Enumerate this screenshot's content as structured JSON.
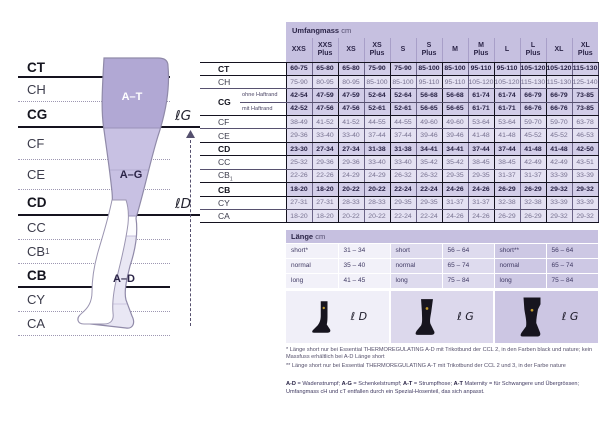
{
  "diagram": {
    "rows": [
      {
        "label": "CT",
        "bold": true
      },
      {
        "label": "CH"
      },
      {
        "label": "CG",
        "bold": true
      },
      {
        "label": "CF"
      },
      {
        "label": "CE"
      },
      {
        "label": "CD",
        "bold": true
      },
      {
        "label": "CC"
      },
      {
        "label": "CB",
        "label_sub": "1"
      },
      {
        "label": "CB",
        "bold": true
      },
      {
        "label": "CY"
      },
      {
        "label": "CA"
      }
    ],
    "region_labels": {
      "at": "A–T",
      "ag": "A–G",
      "ad": "A–D"
    },
    "markers": {
      "lg": "ℓG",
      "ld": "ℓD"
    }
  },
  "umfang": {
    "title": "Umfangmass",
    "unit": "cm",
    "sizes": [
      "XXS",
      "XXS Plus",
      "XS",
      "XS Plus",
      "S",
      "S Plus",
      "M",
      "M Plus",
      "L",
      "L Plus",
      "XL",
      "XL Plus"
    ],
    "rows": [
      {
        "label": "CT",
        "bold": true,
        "thick": true,
        "values": [
          "60-75",
          "65-80",
          "65-80",
          "75-90",
          "75-90",
          "85-100",
          "85-100",
          "95-110",
          "95-110",
          "105-120",
          "105-120",
          "115-130"
        ]
      },
      {
        "label": "CH",
        "values": [
          "75-90",
          "80-95",
          "80-95",
          "85-100",
          "85-100",
          "95-110",
          "95-110",
          "105-120",
          "105-120",
          "115-130",
          "115-130",
          "125-140"
        ]
      },
      {
        "label": "CG",
        "rowspan": 2,
        "sub_label": "ohne Haftrand",
        "bold": true,
        "values": [
          "42-54",
          "47-59",
          "47-59",
          "52-64",
          "52-64",
          "56-68",
          "56-68",
          "61-74",
          "61-74",
          "66-79",
          "66-79",
          "73-85"
        ]
      },
      {
        "sub_label": "mit Haftrand",
        "bold": true,
        "thick": true,
        "values": [
          "42-52",
          "47-56",
          "47-56",
          "52-61",
          "52-61",
          "56-65",
          "56-65",
          "61-71",
          "61-71",
          "66-76",
          "66-76",
          "73-85"
        ]
      },
      {
        "label": "CF",
        "values": [
          "38-49",
          "41-52",
          "41-52",
          "44-55",
          "44-55",
          "49-60",
          "49-60",
          "53-64",
          "53-64",
          "59-70",
          "59-70",
          "63-78"
        ]
      },
      {
        "label": "CE",
        "thick": true,
        "values": [
          "29-36",
          "33-40",
          "33-40",
          "37-44",
          "37-44",
          "39-46",
          "39-46",
          "41-48",
          "41-48",
          "45-52",
          "45-52",
          "46-53"
        ]
      },
      {
        "label": "CD",
        "bold": true,
        "thick": true,
        "values": [
          "23-30",
          "27-34",
          "27-34",
          "31-38",
          "31-38",
          "34-41",
          "34-41",
          "37-44",
          "37-44",
          "41-48",
          "41-48",
          "42-50"
        ]
      },
      {
        "label": "CC",
        "values": [
          "25-32",
          "29-36",
          "29-36",
          "33-40",
          "33-40",
          "35-42",
          "35-42",
          "38-45",
          "38-45",
          "42-49",
          "42-49",
          "43-51"
        ]
      },
      {
        "label": "CB",
        "label_sub": "1",
        "thick": true,
        "values": [
          "22-26",
          "22-26",
          "24-29",
          "24-29",
          "26-32",
          "26-32",
          "29-35",
          "29-35",
          "31-37",
          "31-37",
          "33-39",
          "33-39"
        ]
      },
      {
        "label": "CB",
        "bold": true,
        "thick": true,
        "values": [
          "18-20",
          "18-20",
          "20-22",
          "20-22",
          "22-24",
          "22-24",
          "24-26",
          "24-26",
          "26-29",
          "26-29",
          "29-32",
          "29-32"
        ]
      },
      {
        "label": "CY",
        "values": [
          "27-31",
          "27-31",
          "28-33",
          "28-33",
          "29-35",
          "29-35",
          "31-37",
          "31-37",
          "32-38",
          "32-38",
          "33-39",
          "33-39"
        ]
      },
      {
        "label": "CA",
        "thick": true,
        "values": [
          "18-20",
          "18-20",
          "20-22",
          "20-22",
          "22-24",
          "22-24",
          "24-26",
          "24-26",
          "26-29",
          "26-29",
          "29-32",
          "29-32"
        ]
      }
    ]
  },
  "laenge": {
    "title": "Länge",
    "unit": "cm",
    "groups": [
      {
        "rows": [
          [
            "short*",
            "31 – 34"
          ],
          [
            "normal",
            "35 – 40"
          ],
          [
            "long",
            "41 – 45"
          ]
        ]
      },
      {
        "rows": [
          [
            "short",
            "56 – 64"
          ],
          [
            "normal",
            "65 – 74"
          ],
          [
            "long",
            "75 – 84"
          ]
        ]
      },
      {
        "rows": [
          [
            "short**",
            "56 – 64"
          ],
          [
            "normal",
            "65 – 74"
          ],
          [
            "long",
            "75 – 84"
          ]
        ]
      }
    ],
    "icons": [
      {
        "name": "knee-sock",
        "label": "ℓ D"
      },
      {
        "name": "thigh-sock",
        "label": "ℓ G"
      },
      {
        "name": "pantyhose",
        "label": "ℓ G"
      }
    ]
  },
  "footnotes": [
    "*  Länge short nur bei Essential THERMOREGULATING A-D mit Trikotbund der CCL 2, in den Farben black und nature; kein Massfuss erhältlich bei A-D Länge short",
    "** Länge short nur bei Essential THERMOREGULATING A-T mit Trikotbund der CCL 2 und 3, in der Farbe nature"
  ],
  "footer_segments": [
    {
      "text": "A-D",
      "bold": true
    },
    {
      "text": " = Wadenstrumpf; "
    },
    {
      "text": "A-G",
      "bold": true
    },
    {
      "text": " = Schenkelstrumpf; "
    },
    {
      "text": "A-T",
      "bold": true
    },
    {
      "text": " = Strumpfhose; "
    },
    {
      "text": "A-T",
      "bold": true
    },
    {
      "text": " Maternity = für Schwangere und Übergrössen; Umfangmass cH und cT entfallen durch ein Spezial-Hosenteil, das sich anpasst."
    }
  ],
  "colors": {
    "accent_dark": "#2b2447",
    "lavender_header": "#c6c0e0",
    "band_at": "#b1a8d4",
    "band_ag": "#c8c1e3",
    "band_ad": "#e9e7f4"
  }
}
